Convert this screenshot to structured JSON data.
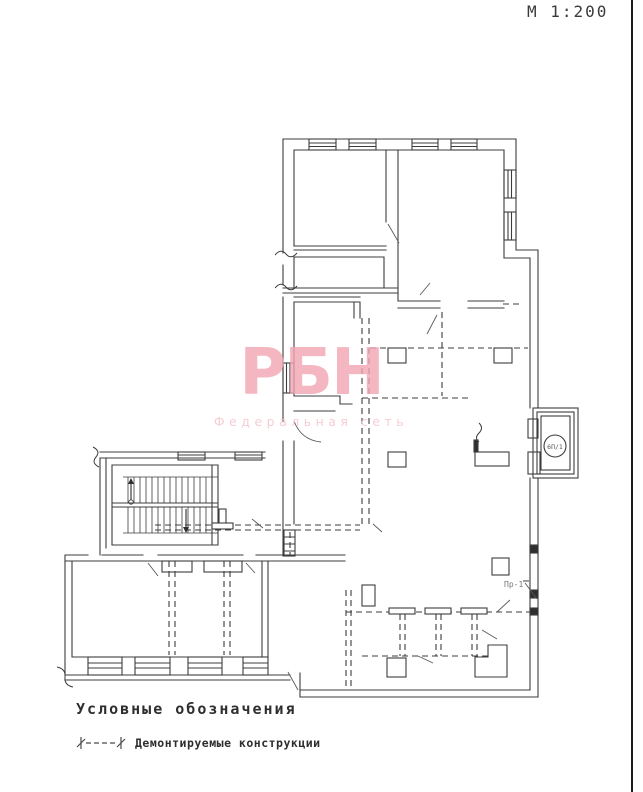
{
  "sheet": {
    "scale_label": "М 1:200"
  },
  "plan": {
    "labels": {
      "shaft_circle": "6П/1",
      "pr_label": "Пр-1"
    }
  },
  "watermark": {
    "logo": "РБН",
    "subtitle": "Федеральная сеть"
  },
  "legend": {
    "title": "Условные обозначения",
    "items": [
      {
        "symbol": "demolition-dashed-line",
        "label": "Демонтируемые конструкции"
      }
    ]
  },
  "colors": {
    "line": "#3c3c3c",
    "watermark": "#f2a6b2",
    "watermark_subtitle": "#f5c9d0",
    "sheet_border": "#1c1c1c",
    "background": "#ffffff"
  }
}
